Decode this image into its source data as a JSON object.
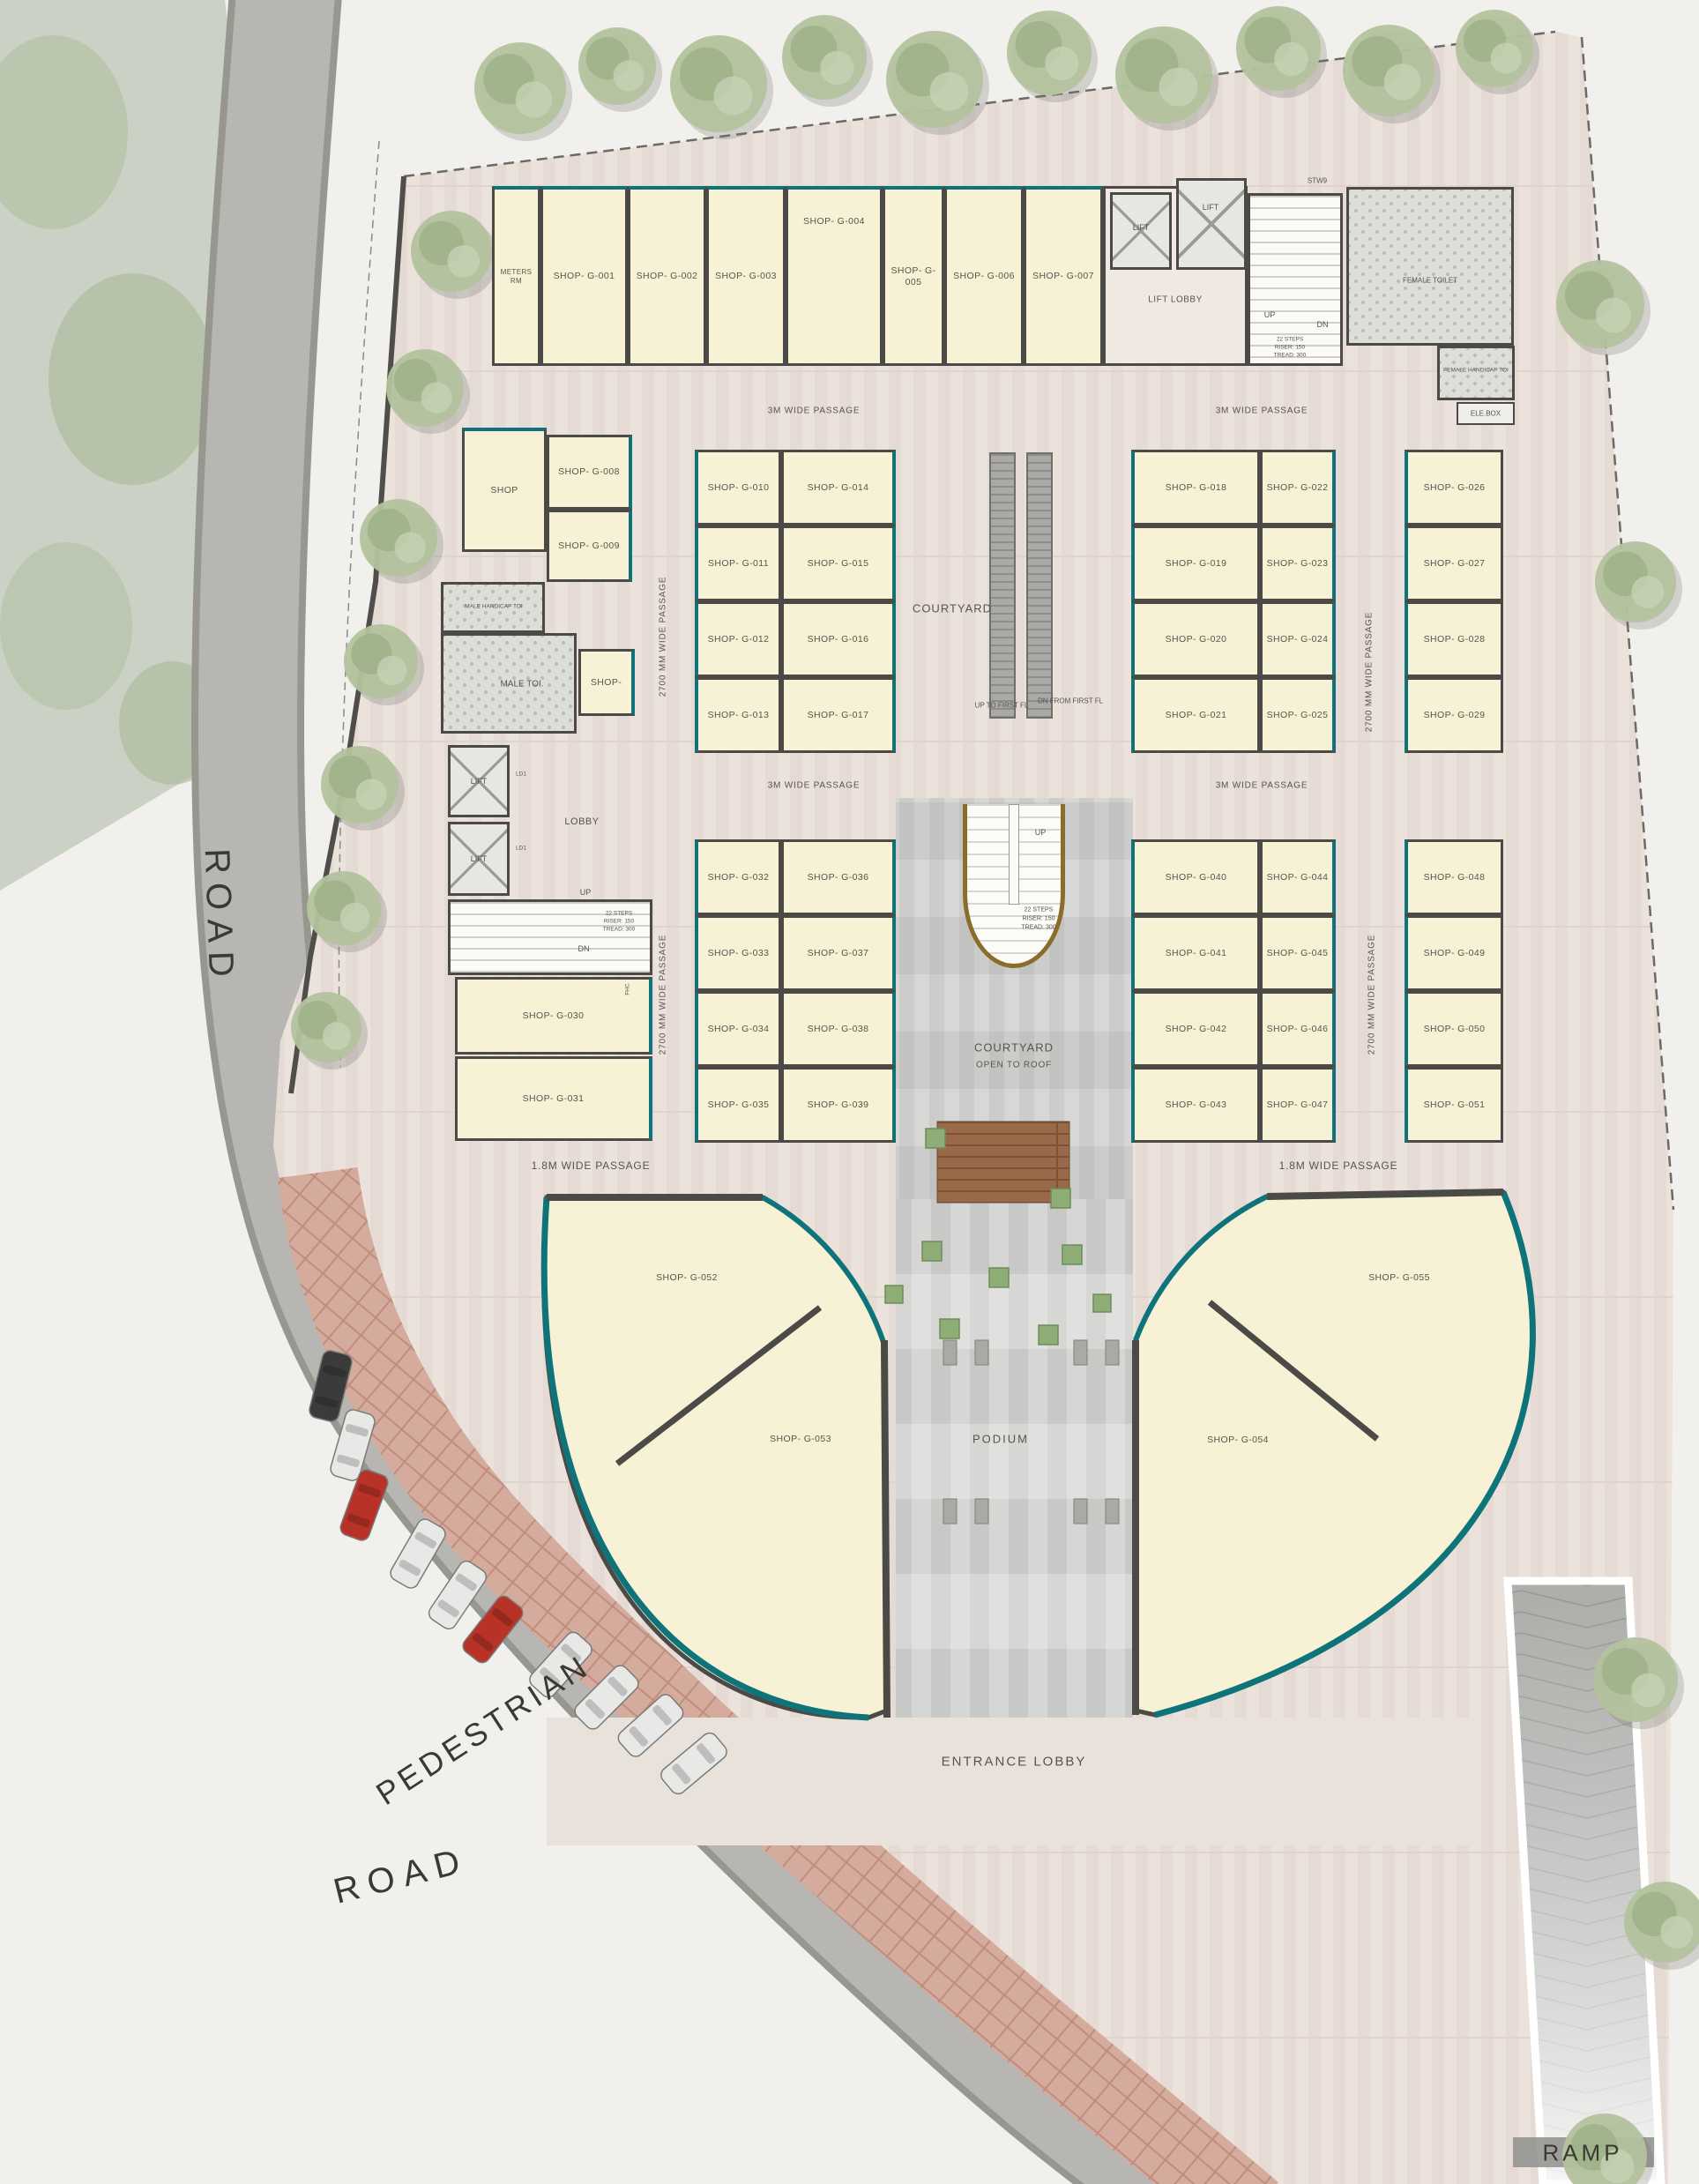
{
  "title": "Ground Floor Plan",
  "site": {
    "road_top": "ROAD",
    "road_bottom": "ROAD",
    "pedestrian": "PEDESTRIAN",
    "ramp": "RAMP",
    "entrance_lobby": "ENTRANCE LOBBY",
    "podium": "PODIUM"
  },
  "passages": {
    "p3m": "3M WIDE PASSAGE",
    "p2700": "2700 MM WIDE PASSAGE",
    "p18m": "1.8M WIDE PASSAGE"
  },
  "cores": {
    "lift": "LIFT",
    "lift_lobby": "LIFT LOBBY",
    "lobby": "LOBBY",
    "ld1": "LD1",
    "stw9": "STW9",
    "up": "UP",
    "dn": "DN",
    "steps_l1": "22 STEPS",
    "steps_l2": "RISER: 150",
    "steps_l3": "TREAD: 300",
    "fhc": "FHC",
    "ele_box": "ELE.BOX",
    "meters_rm": "METERS RM",
    "male_toi": "MALE TOI.",
    "male_hc_toi": "MALE HANDICAP TOI",
    "female_toilet": "FEMALE TOILET",
    "female_hc_toi": "FEMALE HANDICAP TOI",
    "up_to_first": "UP TO FIRST FL",
    "dn_from_first": "DN FROM FIRST FL"
  },
  "courtyards": {
    "courtyard": "COURTYARD",
    "open_l1": "COURTYARD",
    "open_l2": "OPEN TO ROOF"
  },
  "rooms": {
    "shop": "SHOP",
    "shop_small": "SHOP-",
    "g001": "SHOP- G-001",
    "g002": "SHOP- G-002",
    "g003": "SHOP- G-003",
    "g004": "SHOP- G-004",
    "g005": "SHOP- G-005",
    "g006": "SHOP- G-006",
    "g007": "SHOP- G-007",
    "g008": "SHOP- G-008",
    "g009": "SHOP- G-009",
    "g010": "SHOP- G-010",
    "g011": "SHOP- G-011",
    "g012": "SHOP- G-012",
    "g013": "SHOP- G-013",
    "g014": "SHOP- G-014",
    "g015": "SHOP- G-015",
    "g016": "SHOP- G-016",
    "g017": "SHOP- G-017",
    "g018": "SHOP- G-018",
    "g019": "SHOP- G-019",
    "g020": "SHOP- G-020",
    "g021": "SHOP- G-021",
    "g022": "SHOP- G-022",
    "g023": "SHOP- G-023",
    "g024": "SHOP- G-024",
    "g025": "SHOP- G-025",
    "g026": "SHOP- G-026",
    "g027": "SHOP- G-027",
    "g028": "SHOP- G-028",
    "g029": "SHOP- G-029",
    "g030": "SHOP- G-030",
    "g031": "SHOP- G-031",
    "g032": "SHOP- G-032",
    "g033": "SHOP- G-033",
    "g034": "SHOP- G-034",
    "g035": "SHOP- G-035",
    "g036": "SHOP- G-036",
    "g037": "SHOP- G-037",
    "g038": "SHOP- G-038",
    "g039": "SHOP- G-039",
    "g040": "SHOP- G-040",
    "g041": "SHOP- G-041",
    "g042": "SHOP- G-042",
    "g043": "SHOP- G-043",
    "g044": "SHOP- G-044",
    "g045": "SHOP- G-045",
    "g046": "SHOP- G-046",
    "g047": "SHOP- G-047",
    "g048": "SHOP- G-048",
    "g049": "SHOP- G-049",
    "g050": "SHOP- G-050",
    "g051": "SHOP- G-051",
    "g052": "SHOP- G-052",
    "g053": "SHOP- G-053",
    "g054": "SHOP- G-054",
    "g055": "SHOP- G-055"
  },
  "colors": {
    "wall": "#4b4a46",
    "shopfront": "#0f747a",
    "shop_fill": "#f7f2d6",
    "stair_accent": "#8a6d2a"
  }
}
